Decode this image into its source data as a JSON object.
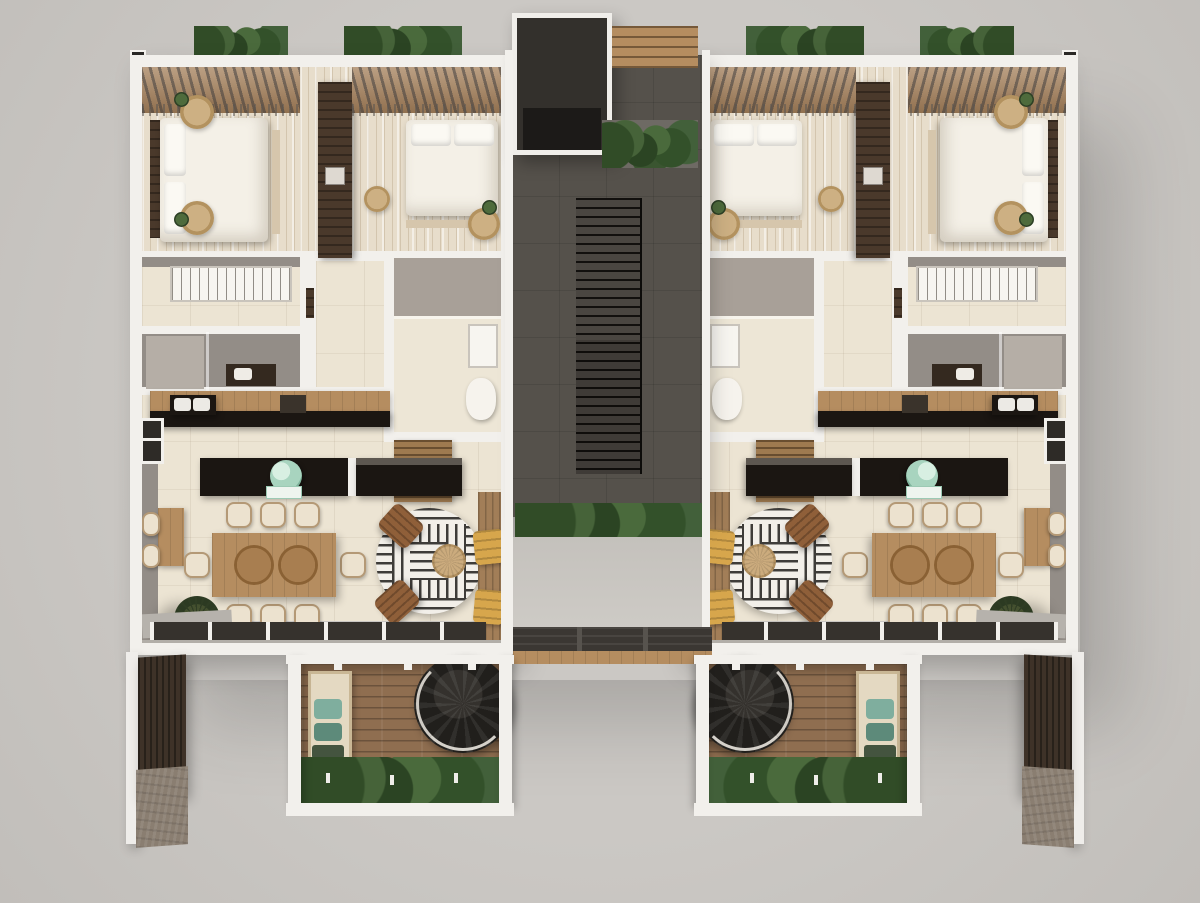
{
  "scene": {
    "type": "3d-floor-plan-render",
    "view": "top-down isometric",
    "description": "Photorealistic top-down render of a residential floor: two mirrored apartment units flanking a central circulation core with elevator and staircase, rear patios with spiral staircases and hedges, roof-edge planters, and dark timber street facade panels at the bottom corners.",
    "unit_count": 2,
    "has_text_labels": false
  },
  "palette": {
    "ground": "#c7c4c0",
    "wall_white": "#f2f0ec",
    "wall_gray": "#938d87",
    "floor_plank_beige": "#e7ddcb",
    "floor_tile_cream": "#ece4d3",
    "core_charcoal": "#55514b",
    "stair_tread_black": "#12100e",
    "wood_light": "#b58d60",
    "wood_medium": "#9c7a52",
    "wood_dark": "#4a392b",
    "counter_black": "#1b1612",
    "glass_dark": "#36322d",
    "greenery_dark": "#2e4126",
    "greenery_light": "#466339",
    "teal_accent": "#a8d4bf",
    "teal_pillow": "#7fae9e",
    "ochre_cushion": "#d7a64c",
    "rug_jute_tan": "#c2a074",
    "textile_white": "#f4f0e7",
    "concrete_base": "#8a7e71",
    "deck_brown": "#8f6e50"
  },
  "components": {
    "core": [
      "elevator-shaft",
      "tiled-lobby",
      "straight-staircase",
      "planter-box",
      "shrub-bed",
      "pergola-bridge"
    ],
    "apartment": [
      "bedroom-1",
      "bedroom-2",
      "wardrobe-divider",
      "walk-in-closet",
      "bathroom-1",
      "bathroom-2",
      "laundry-closet",
      "kitchen-counter",
      "kitchen-island",
      "dining-table-8-seats",
      "console-desk",
      "living-rug-armchairs",
      "lounger-balcony",
      "window-wall"
    ],
    "patio": [
      "timber-deck",
      "daybed",
      "spiral-staircase",
      "hedge-row"
    ],
    "street_facade": [
      "white-fin-wall",
      "dark-timber-panel",
      "concrete-base"
    ]
  }
}
